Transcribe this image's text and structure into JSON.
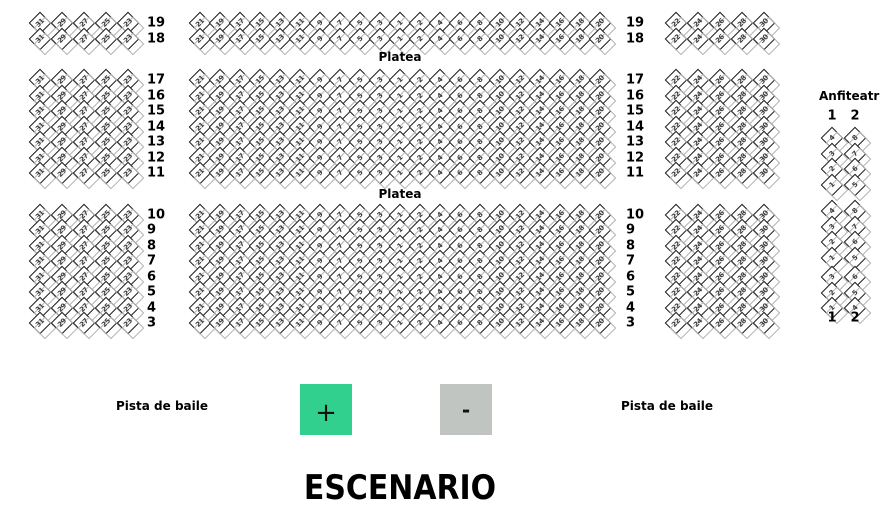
{
  "labels": {
    "platea_top": "Platea",
    "platea_middle": "Platea",
    "anfiteatro_title": "Anfiteatro",
    "pista_de_baile_left": "Pista de baile",
    "pista_de_baile_right": "Pista de baile",
    "escenario": "ESCENARIO"
  },
  "zoom_controls": {
    "zoom_in_label": "+",
    "zoom_out_label": "-",
    "zoom_in_color": "#31d08f",
    "zoom_out_color": "#c1c5c1"
  },
  "platea": {
    "row_sections": [
      {
        "rows": [
          "19",
          "18"
        ]
      },
      {
        "rows": [
          "17",
          "16",
          "15",
          "14",
          "13",
          "12",
          "11"
        ]
      },
      {
        "rows": [
          "10",
          "9",
          "8",
          "7",
          "6",
          "5",
          "4",
          "3"
        ]
      }
    ],
    "left_block_seats": [
      "31",
      "29",
      "27",
      "25",
      "23"
    ],
    "center_block_seats": [
      "21",
      "19",
      "17",
      "15",
      "13",
      "11",
      "9",
      "7",
      "5",
      "3",
      "1",
      "2",
      "4",
      "6",
      "8",
      "10",
      "12",
      "14",
      "16",
      "18",
      "20"
    ],
    "right_block_seats": [
      "22",
      "24",
      "26",
      "28",
      "30"
    ]
  },
  "anfiteatro": {
    "column_labels_top": [
      "1",
      "2"
    ],
    "column_labels_bottom": [
      "1",
      "2"
    ],
    "blocks": [
      {
        "columns": [
          [
            "4",
            "3",
            "2",
            "1"
          ],
          [
            "8",
            "7",
            "6",
            "5"
          ]
        ]
      },
      {
        "columns": [
          [
            "4",
            "3",
            "2",
            "1"
          ],
          [
            "8",
            "7",
            "6",
            "5"
          ]
        ]
      },
      {
        "columns": [
          [
            "3",
            "2",
            "1"
          ],
          [
            "6",
            "5",
            "4"
          ]
        ]
      }
    ]
  }
}
